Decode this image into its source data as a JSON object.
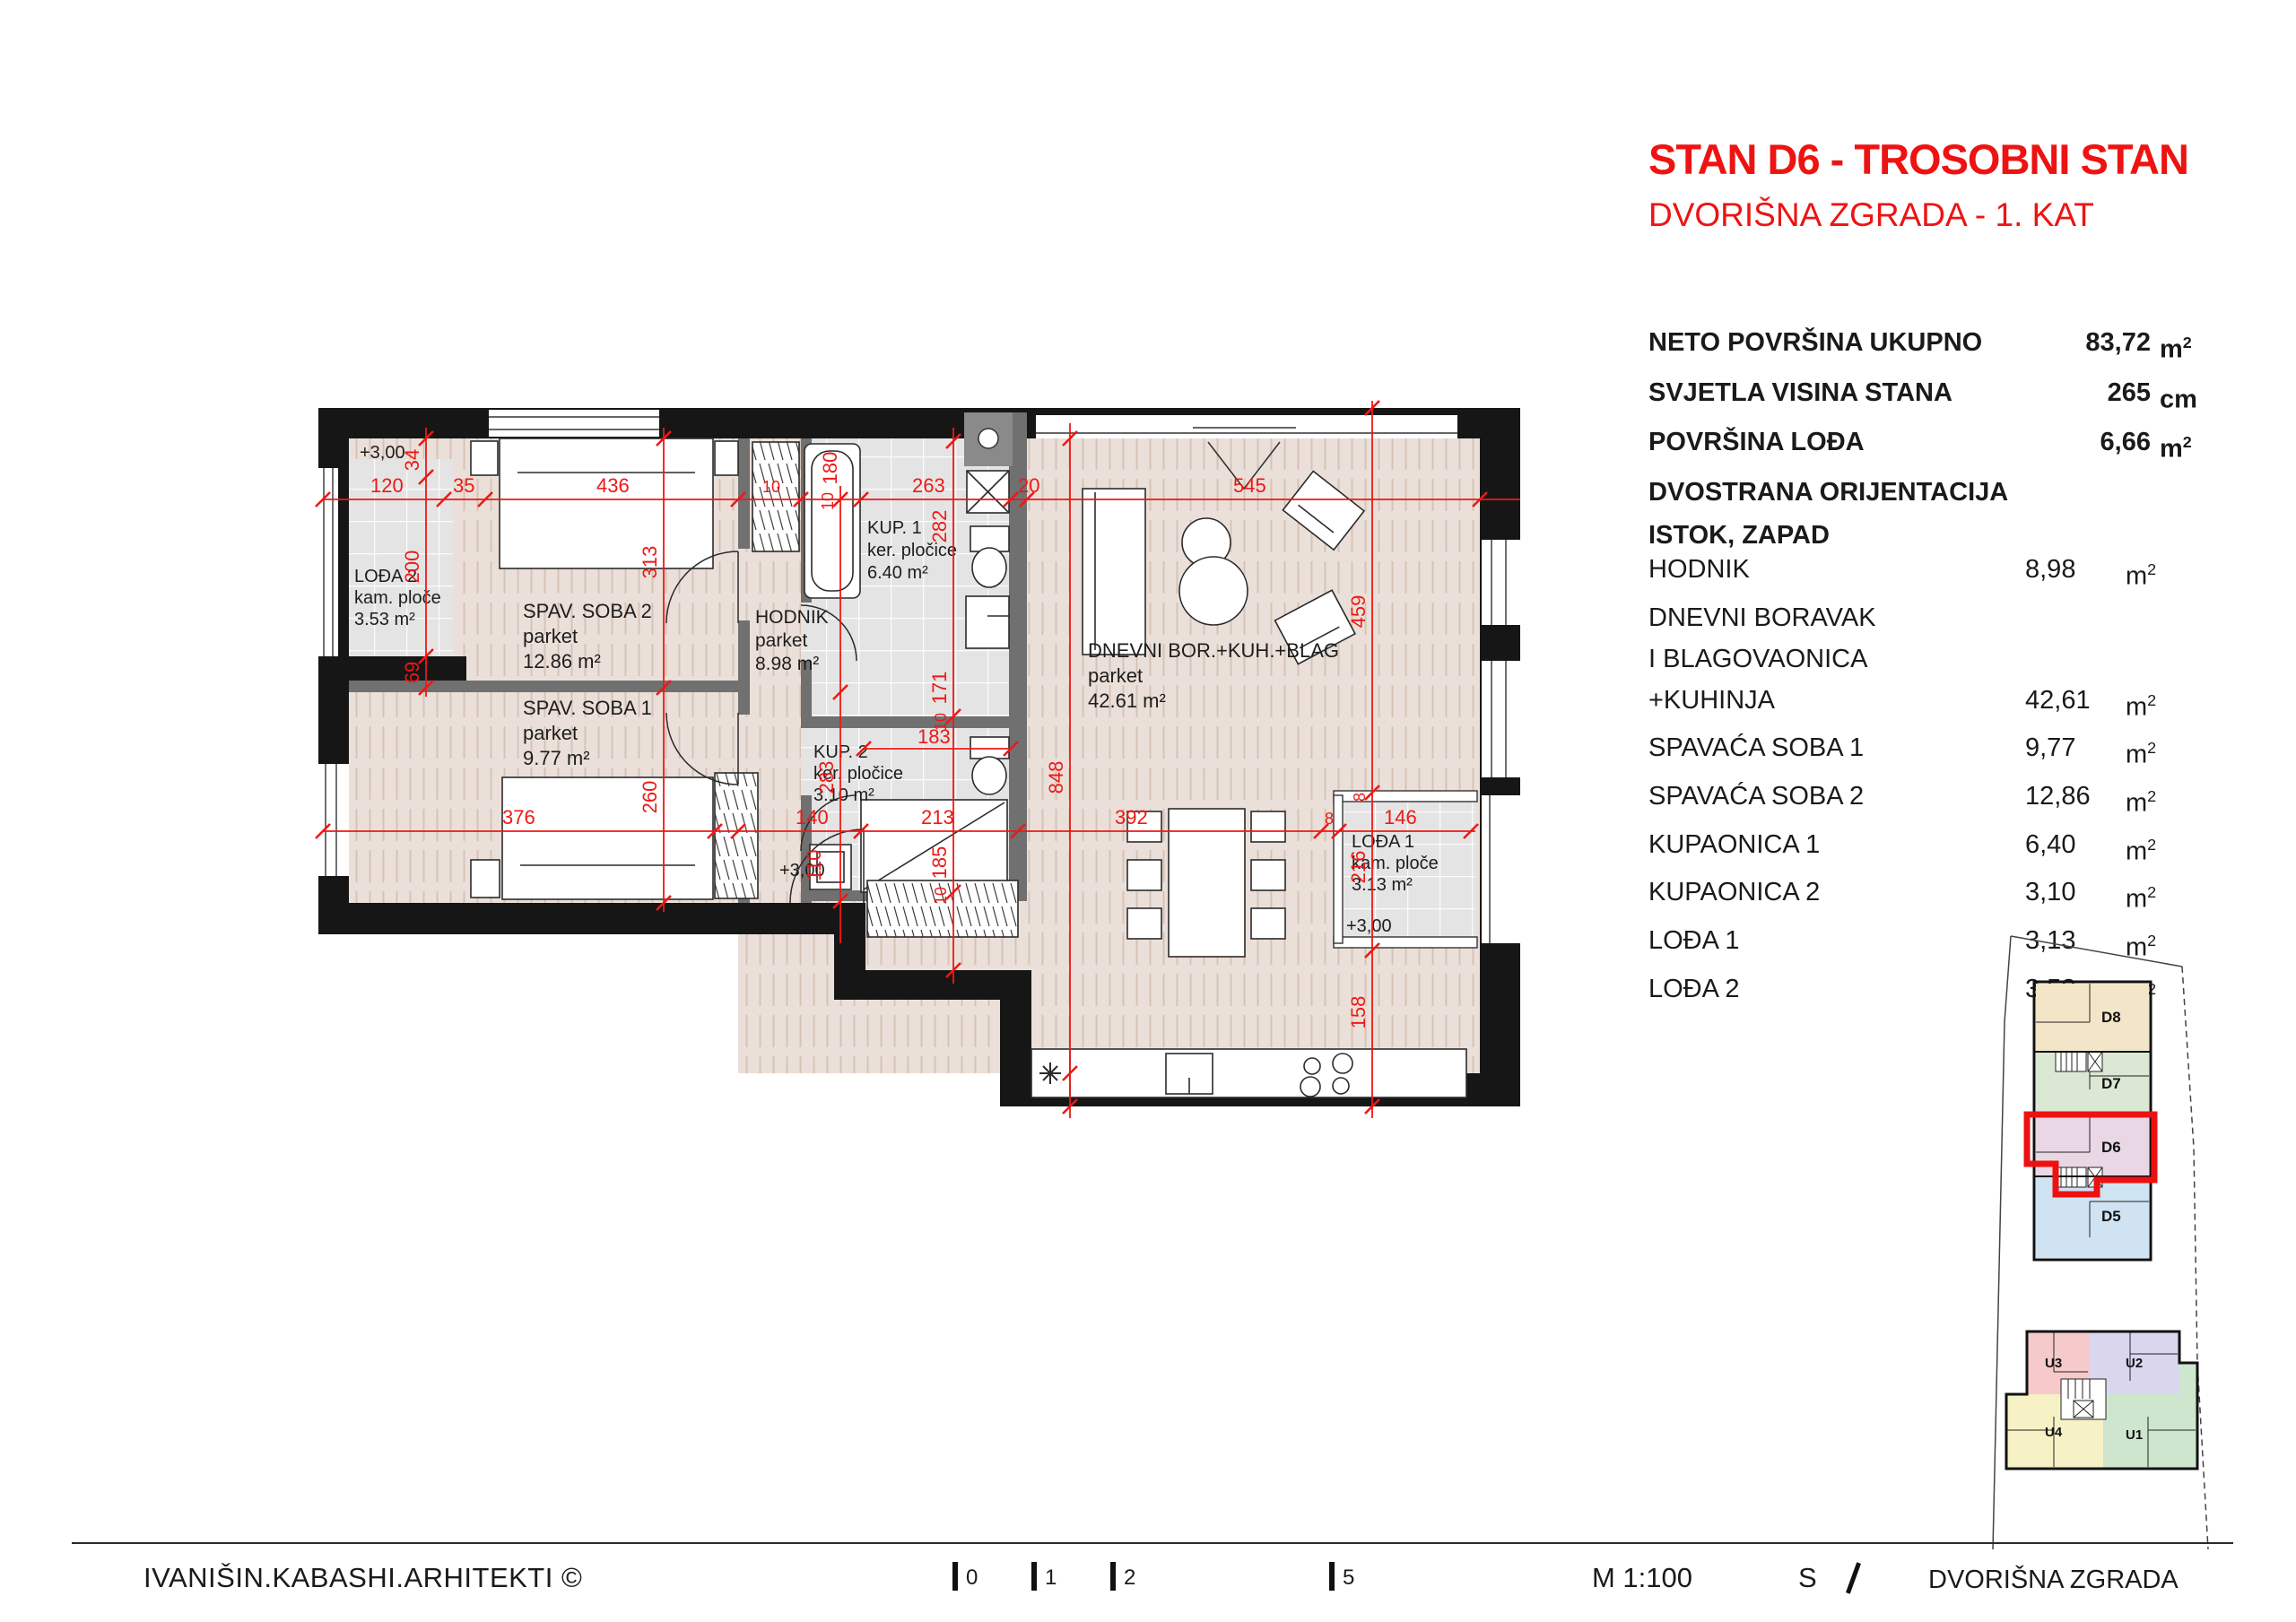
{
  "header": {
    "title": "STAN D6 - TROSOBNI STAN",
    "subtitle": "DVORIŠNA ZGRADA - 1. KAT"
  },
  "stats": {
    "rows": [
      {
        "label": "NETO POVRŠINA UKUPNO",
        "value": "83,72",
        "unit": "m",
        "sup": "2"
      },
      {
        "label": "SVJETLA VISINA STANA",
        "value": "265",
        "unit": "cm",
        "sup": ""
      },
      {
        "label": "POVRŠINA LOĐA",
        "value": "6,66",
        "unit": "m",
        "sup": "2"
      }
    ],
    "orientation1": "DVOSTRANA ORIJENTACIJA",
    "orientation2": "ISTOK, ZAPAD"
  },
  "room_list": [
    {
      "name": "HODNIK",
      "value": "8,98",
      "unit": "m",
      "sup": "2"
    },
    {
      "name": "DNEVNI BORAVAK",
      "value": "",
      "unit": "",
      "sup": ""
    },
    {
      "name": "I BLAGOVAONICA",
      "value": "",
      "unit": "",
      "sup": ""
    },
    {
      "name": "+KUHINJA",
      "value": "42,61",
      "unit": "m",
      "sup": "2"
    },
    {
      "name": "SPAVAĆA SOBA 1",
      "value": "9,77",
      "unit": "m",
      "sup": "2"
    },
    {
      "name": "SPAVAĆA SOBA 2",
      "value": "12,86",
      "unit": "m",
      "sup": "2"
    },
    {
      "name": "KUPAONICA 1",
      "value": "6,40",
      "unit": "m",
      "sup": "2"
    },
    {
      "name": "KUPAONICA 2",
      "value": "3,10",
      "unit": "m",
      "sup": "2"
    },
    {
      "name": "LOĐA 1",
      "value": "3,13",
      "unit": "m",
      "sup": "2"
    },
    {
      "name": "LOĐA 2",
      "value": "3,53",
      "unit": "m",
      "sup": "2"
    }
  ],
  "plan": {
    "level": "+3,00",
    "rooms": {
      "soba2": {
        "name": "SPAV. SOBA 2",
        "floor": "parket",
        "area": "12.86 m²"
      },
      "soba1": {
        "name": "SPAV. SOBA 1",
        "floor": "parket",
        "area": "9.77 m²"
      },
      "hodnik": {
        "name": "HODNIK",
        "floor": "parket",
        "area": "8.98 m²"
      },
      "kup1": {
        "name": "KUP. 1",
        "floor": "ker. pločice",
        "area": "6.40 m²"
      },
      "kup2": {
        "name": "KUP. 2",
        "floor": "ker. pločice",
        "area": "3.10 m²"
      },
      "dnevni": {
        "name": "DNEVNI BOR.+KUH.+BLAG",
        "floor": "parket",
        "area": "42.61 m²"
      },
      "loda1": {
        "name": "LOĐA 1",
        "floor": "kam. ploče",
        "area": "3.13 m²"
      },
      "loda2": {
        "name": "LOĐA 2",
        "floor": "kam. ploče",
        "area": "3.53 m²"
      }
    },
    "dims": {
      "d120": "120",
      "d35": "35",
      "d436": "436",
      "d180": "180",
      "d263": "263",
      "d20": "20",
      "d545": "545",
      "d34": "34",
      "d200": "200",
      "d69": "69",
      "d313": "313",
      "d260": "260",
      "d283": "283",
      "d282": "282",
      "d171": "171",
      "d183": "183",
      "d848": "848",
      "d459": "459",
      "d376": "376",
      "d140": "140",
      "d110": "110",
      "d213": "213",
      "d392": "392",
      "d146": "146",
      "d216": "216",
      "d158": "158",
      "d185": "185",
      "d10": "10",
      "d8": "8"
    }
  },
  "minimap": {
    "units": {
      "d8": "D8",
      "d7": "D7",
      "d6": "D6",
      "d5": "D5",
      "u1": "U1",
      "u2": "U2",
      "u3": "U3",
      "u4": "U4"
    },
    "colors": {
      "d8": "#f3e6c8",
      "d7": "#dbe8d4",
      "d6": "#ead7e5",
      "d5": "#cfe3f2",
      "u3": "#f6caca",
      "u2": "#d9d6ee",
      "u4": "#f6f2c6",
      "u1": "#cde6cd",
      "highlight": "#ee1111"
    }
  },
  "footer": {
    "firm": "IVANIŠIN.KABASHI.ARHITEKTI ©",
    "scale_marks": [
      "0",
      "1",
      "2",
      "5"
    ],
    "scale": "M 1:100",
    "north": "S",
    "building": "DVORIŠNA ZGRADA"
  }
}
